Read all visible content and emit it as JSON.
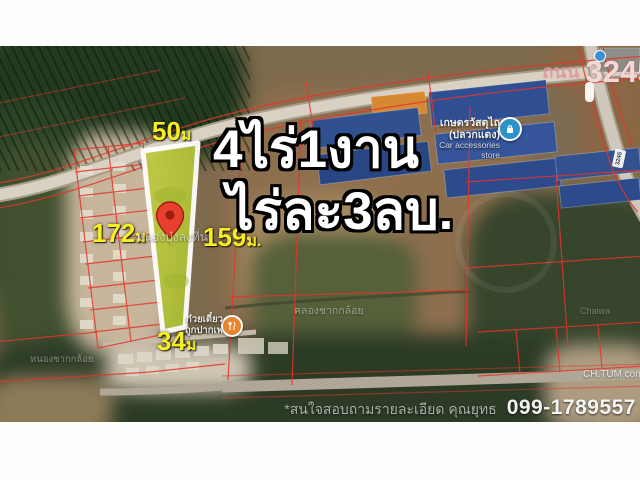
{
  "listing": {
    "area_text": "4ไร่1งาน",
    "price_text": "ไร่ละ3ลบ.",
    "dimensions": {
      "top": {
        "value": "50",
        "unit": "ม"
      },
      "left": {
        "value": "172",
        "unit": "ม"
      },
      "right": {
        "value": "159",
        "unit": "ม."
      },
      "bottom": {
        "value": "34",
        "unit": "ม"
      }
    },
    "contact_note": "*สนใจสอบถามรายละเอียด คุณยุทธ",
    "phone": "099-1789557"
  },
  "map": {
    "road_label": {
      "prefix": "ถนน",
      "number": "3245"
    },
    "road_shield": "3245",
    "watermarks": {
      "road_name": "หนองบุ๋งลงที่น",
      "canal": "คลองชากกล้อย",
      "pond": "หนองชากกล้อย",
      "company": "CH.TUM constru",
      "place": "Chaiwa"
    },
    "poi": {
      "store": {
        "name_line1": "เกษตรวัสดุไถ",
        "name_line2": "(ปลวกแดง)",
        "category": "Car accessories store"
      },
      "restaurant": {
        "name_line1": "ก๋วยเตี๋ยว",
        "name_line2": "ถูกปากเพ"
      }
    }
  },
  "colors": {
    "plot_fill": "#b5c33b",
    "plot_outline": "#ffffff",
    "dimension_label": "#f6ee1f",
    "parcel_line": "#e5352b",
    "pin": "#e8402d",
    "store_marker": "#2a93c9",
    "restaurant_marker": "#e8862d",
    "road_number_text": "#f3d8d6"
  }
}
